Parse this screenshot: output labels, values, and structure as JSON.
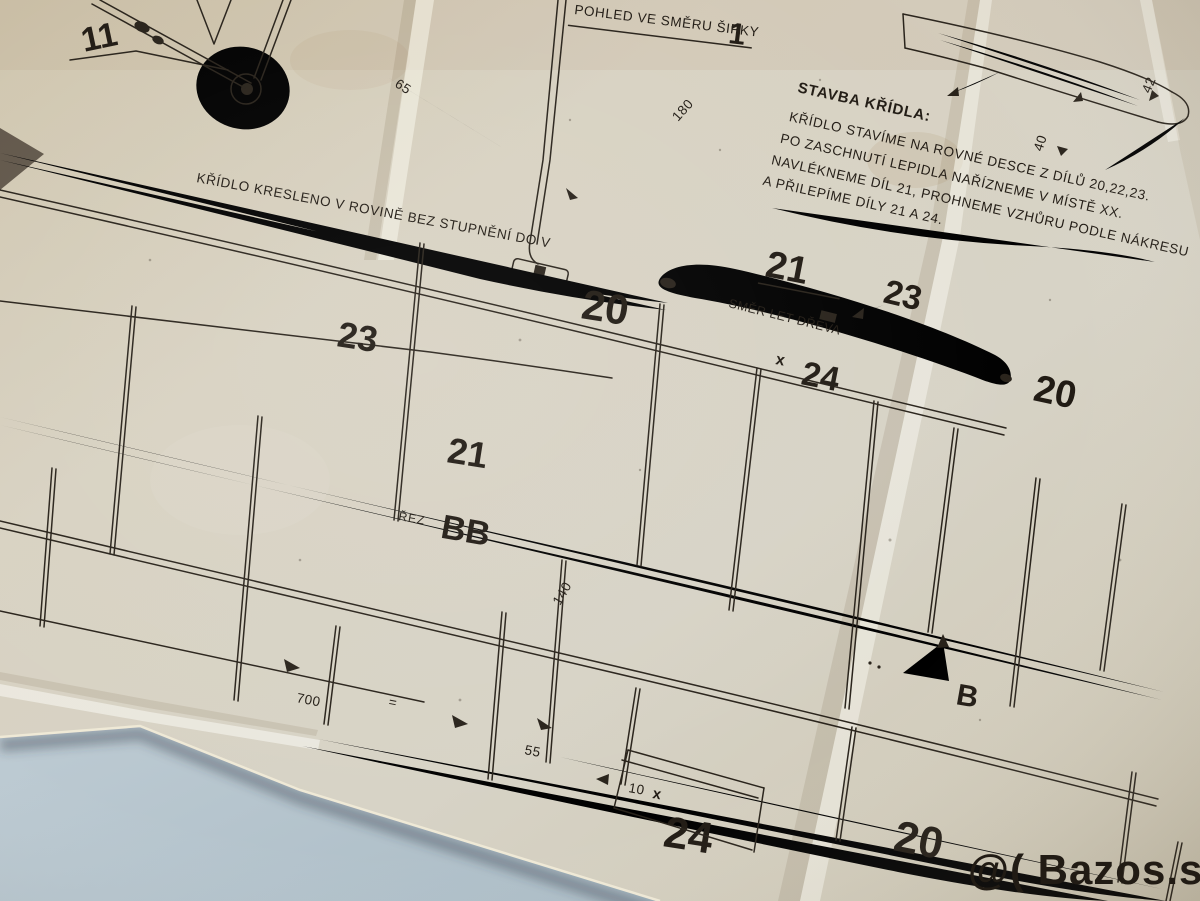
{
  "photo": {
    "watermark": "@( Bazos.sk"
  },
  "plan": {
    "notes": {
      "construction_title": "STAVBA KŘÍDLA:",
      "construction_lines": [
        "KŘÍDLO STAVÍME NA ROVNÉ DESCE Z DÍLŮ 20,22,23.",
        "PO ZASCHNUTÍ LEPIDLA NAŘÍZNEME V MÍSTĚ XX.",
        "NAVLÉKNEME DÍL 21, PROHNEME VZHŮRU PODLE NÁKRESU",
        "A PŘILEPÍME DÍLY 21 A 24."
      ],
      "view_label": "POHLED VE SMĚRU ŠIPKY",
      "view_arrow_number": "1",
      "wing_drawn_note": "KŘÍDLO KRESLENO V ROVINĚ BEZ STUPNĚNÍ DO V",
      "grain_direction": "SMĚR LET DŘEVA",
      "section_word": "ŘEZ",
      "section_name": "BB",
      "section_marker": "B"
    },
    "part_labels": {
      "landing_gear": "11",
      "left_rib": "23",
      "left_spar": "21",
      "center_nose": "20",
      "top_rib": "21",
      "right_rib": "23",
      "right_tip": "20",
      "mid_strip": "24",
      "bottom_strip": "24",
      "bottom_edge": "20"
    },
    "dimensions": {
      "d65": "65",
      "d180": "180",
      "d40": "40",
      "d42": "42",
      "d140": "140",
      "d700": "700",
      "d55": "55",
      "d10": "10",
      "x_mark": "x",
      "equals_mark": "="
    }
  }
}
